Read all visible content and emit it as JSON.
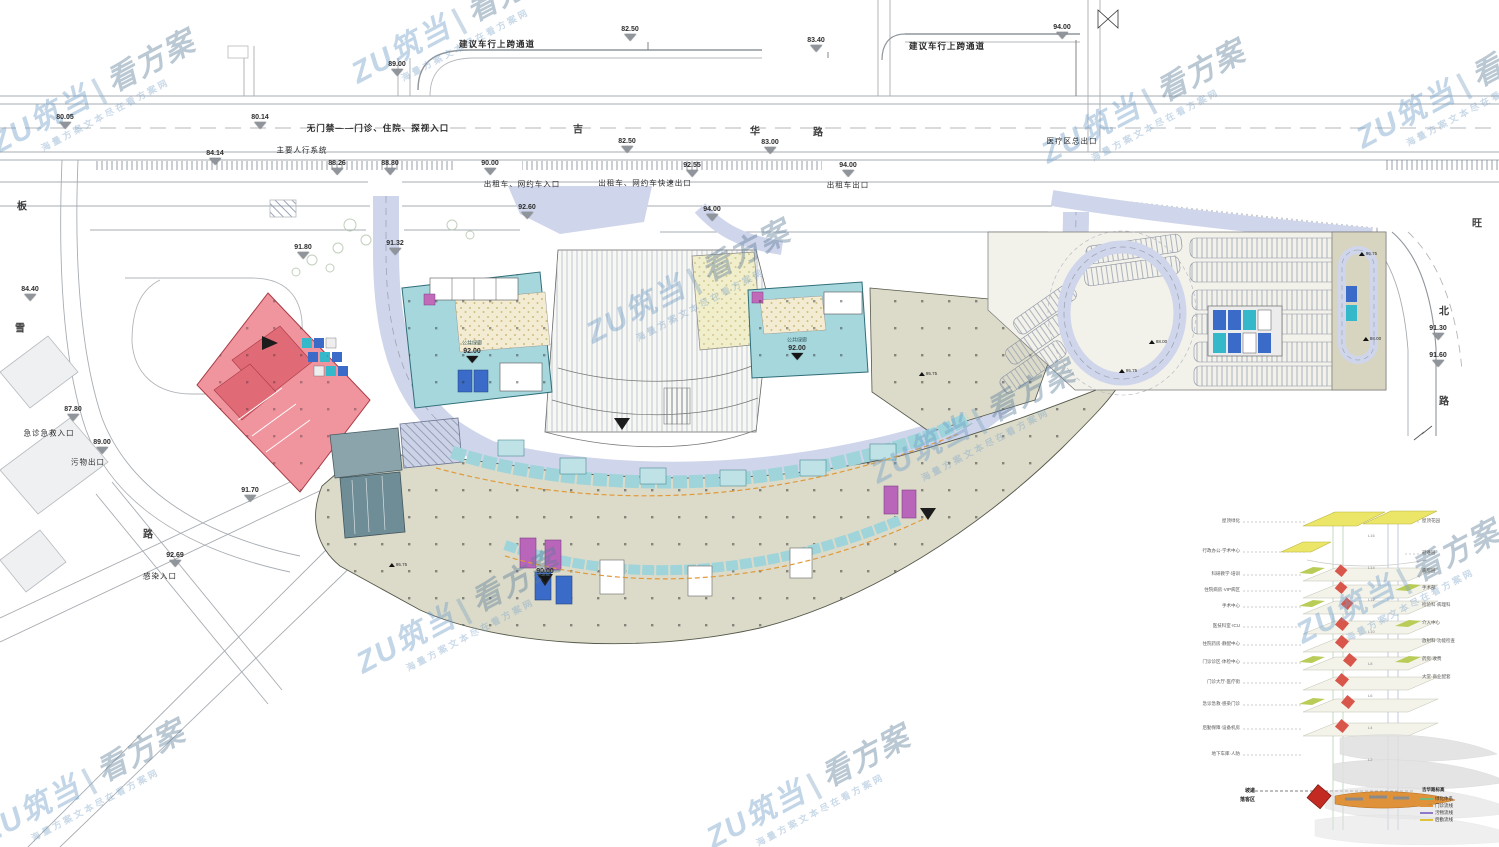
{
  "watermark": {
    "brand": "ZU筑当",
    "divider": "|",
    "suffix": "看方案",
    "tagline": "海量方案文本尽在看方案网"
  },
  "roads": {
    "jihua": [
      "吉",
      "华",
      "路"
    ],
    "left_road": [
      "板",
      "雪"
    ],
    "left_road_bottom": "路",
    "right_road": [
      "旺",
      "北",
      "路"
    ]
  },
  "labels": {
    "overpass": "建议车行上跨通道",
    "no_gate_entrance": "无门禁——门诊、住院、探视入口",
    "pedestrian_system": "主要人行系统",
    "taxi_entrance": "出租车、网约车入口",
    "taxi_fast_exit": "出租车、网约车快速出口",
    "taxi_exit": "出租车出口",
    "medical_exit": "医疗区总出口",
    "emergency_entrance": "急诊急救入口",
    "waste_exit": "污物出口",
    "infection_entrance": "感染入口",
    "green_corridor": "公共绿廊"
  },
  "elevations": [
    "82.50",
    "83.40",
    "94.00",
    "89.00",
    "80.05",
    "80.14",
    "84.14",
    "88.26",
    "88.80",
    "90.00",
    "82.50",
    "83.00",
    "92.55",
    "94.00",
    "92.60",
    "94.00",
    "84.40",
    "87.80",
    "89.00",
    "92.69",
    "91.80",
    "91.32",
    "91.70",
    "91.30",
    "91.60",
    "92.00",
    "92.00",
    "90.00",
    "95.75",
    "95.75",
    "95.75",
    "88.00",
    "88.00",
    "95.75"
  ],
  "stack": {
    "left_labels": [
      "屋顶绿化",
      "行政办公·学术中心",
      "科研教学·培训",
      "住院病房·VIP病区",
      "手术中心",
      "医技科室·ICU",
      "住院药房·静配中心",
      "门诊诊区·体检中心",
      "门诊大厅·医疗街",
      "急诊急救·感染门诊",
      "后勤保障·设备机房",
      "地下车库·人防"
    ],
    "right_labels": [
      "屋顶花园",
      "避难层",
      "病房层",
      "手术部",
      "检验科·病理科",
      "介入中心",
      "放射科·功能检查",
      "药房·收费",
      "大堂·商业配套",
      "吉华路标高"
    ],
    "tags": [
      "L16",
      "L14",
      "L12",
      "L10",
      "L8",
      "L6",
      "L4",
      "L2"
    ],
    "bottom_labels": [
      "坡道",
      "落客区"
    ],
    "legend_labels": [
      "绿化体系",
      "门诊流线",
      "污物流线",
      "后勤流线"
    ]
  },
  "colors": {
    "teal_block": "#a6d7dd",
    "pink_building": "#f0949e",
    "lavender_road": "#cfd5ea",
    "podium_beige": "#dcdbc9",
    "magenta_room": "#b965ba",
    "blue_room": "#3a6bc9",
    "yellow_plate": "#ece668",
    "red_cluster": "#d9564a",
    "green_cluster": "#b9cc57",
    "legend_green": "#7ab87a",
    "legend_orange": "#e0923a",
    "legend_purple": "#8f7ac9",
    "legend_yellow": "#e0c23a",
    "watermark_blue": "#6f9ec9"
  }
}
